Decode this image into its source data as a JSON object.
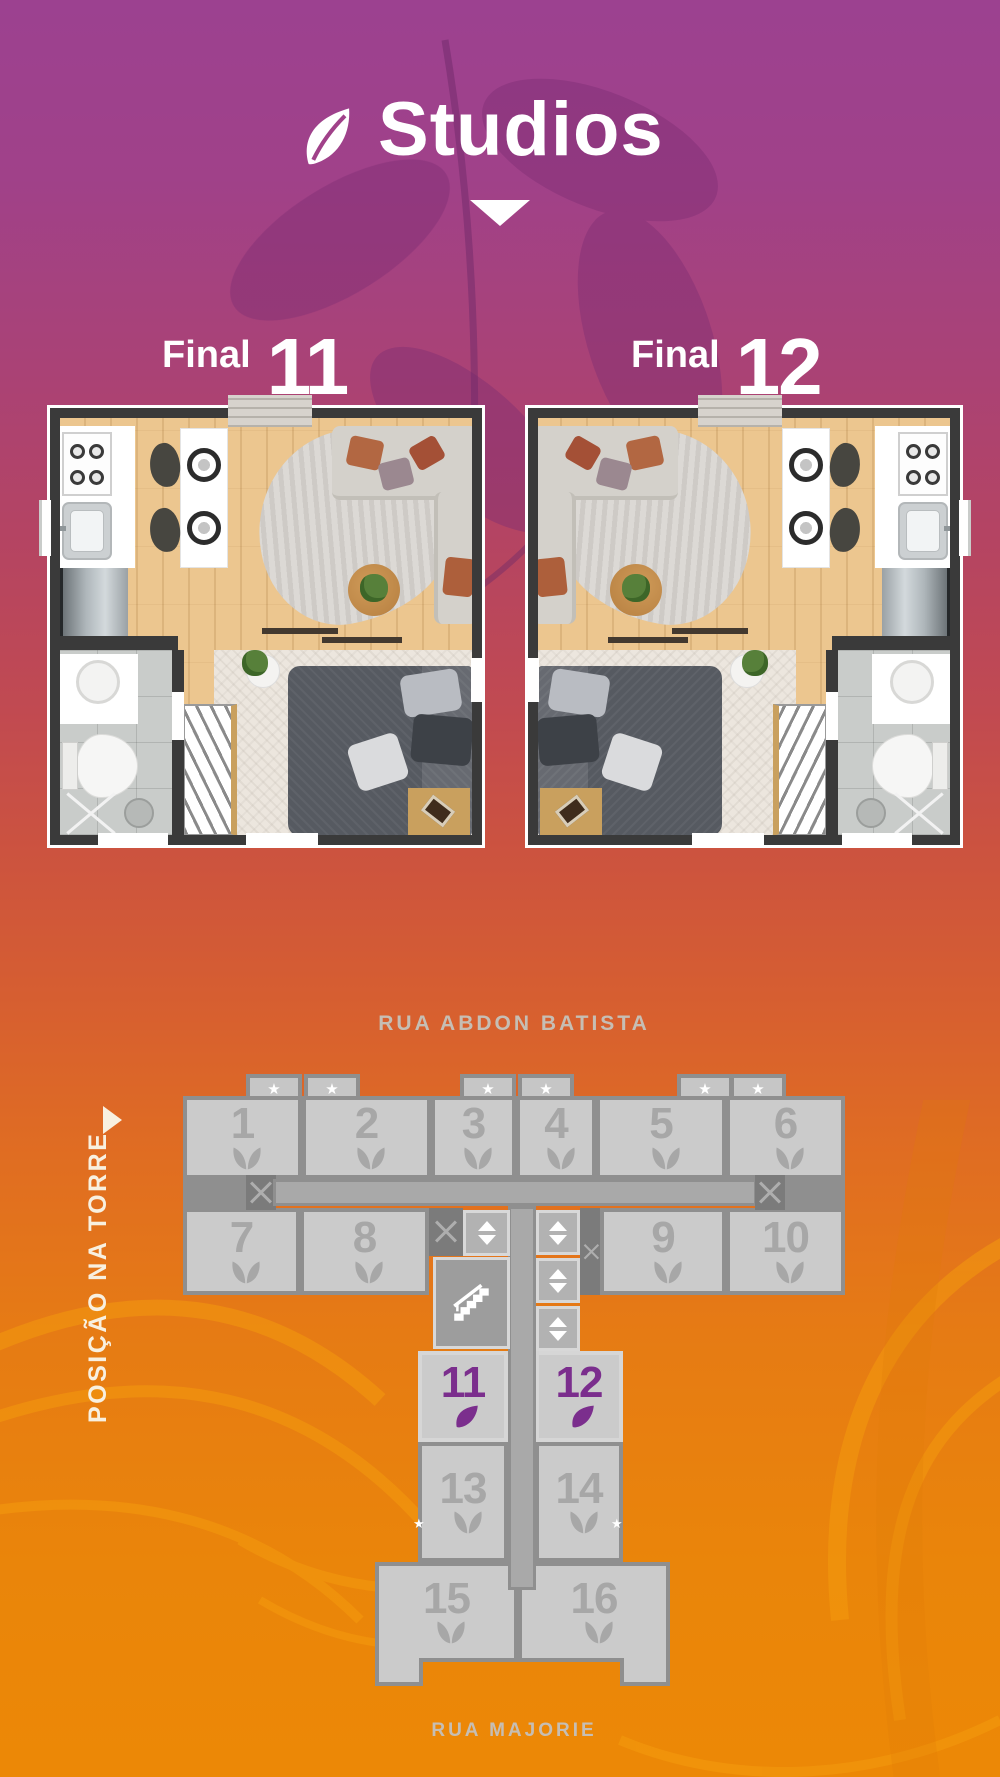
{
  "title": {
    "text": "Studios"
  },
  "finals": [
    {
      "label": "Final",
      "number": "11"
    },
    {
      "label": "Final",
      "number": "12"
    }
  ],
  "tower": {
    "street_top": "RUA ABDON BATISTA",
    "street_bottom": "RUA MAJORIE",
    "position_label": "POSIÇÃO NA TORRE",
    "highlighted_units": [
      "11",
      "12"
    ],
    "units": [
      {
        "number": "1",
        "star": true,
        "highlighted": false
      },
      {
        "number": "2",
        "star": true,
        "highlighted": false
      },
      {
        "number": "3",
        "star": true,
        "highlighted": false
      },
      {
        "number": "4",
        "star": true,
        "highlighted": false
      },
      {
        "number": "5",
        "star": true,
        "highlighted": false
      },
      {
        "number": "6",
        "star": true,
        "highlighted": false
      },
      {
        "number": "7",
        "star": false,
        "highlighted": false
      },
      {
        "number": "8",
        "star": false,
        "highlighted": false
      },
      {
        "number": "9",
        "star": false,
        "highlighted": false
      },
      {
        "number": "10",
        "star": false,
        "highlighted": false
      },
      {
        "number": "11",
        "star": false,
        "highlighted": true
      },
      {
        "number": "12",
        "star": false,
        "highlighted": true
      },
      {
        "number": "13",
        "star": true,
        "highlighted": false
      },
      {
        "number": "14",
        "star": true,
        "highlighted": false
      },
      {
        "number": "15",
        "star": false,
        "highlighted": false
      },
      {
        "number": "16",
        "star": false,
        "highlighted": false
      }
    ]
  },
  "icons": {
    "star": "★"
  },
  "colors": {
    "bg_top": "#9c4190",
    "bg_bottom": "#ec8806",
    "accent_purple": "#7b2e8d",
    "unit_gray": "#cbcbcb",
    "label_cream": "#f8f0e0",
    "street_gray": "#c6beb4"
  }
}
